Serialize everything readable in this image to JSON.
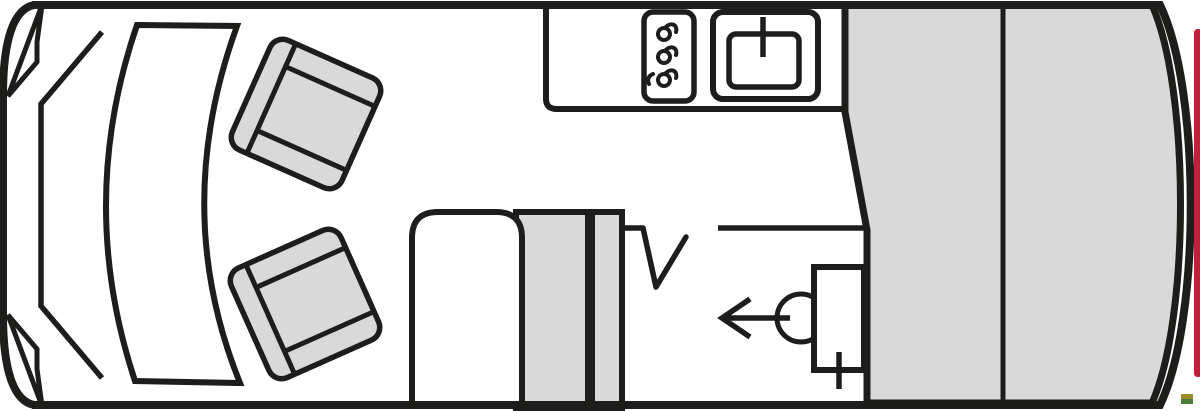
{
  "colors": {
    "line": "#1d1d1b",
    "floor_white": "#ffffff",
    "furniture_gray": "#d9d9d9",
    "bed_gray": "#d9d9d9",
    "accent_red": "#c41f38",
    "mark_olive": "#9c8b2d",
    "mark_green": "#4d7c34"
  },
  "plan": {
    "type": "campervan-floorplan-top-view",
    "swivel_seat_count": 2,
    "hob_burner_count": 3,
    "bed_section_count": 2,
    "areas": {
      "cab": "driver-cab",
      "kitchen": "kitchen-block",
      "lounge": "side-bench-and-cabinet",
      "bathroom": "washroom",
      "bed": "rear-transverse-bed",
      "entrance": "entry-door-arrow"
    }
  }
}
